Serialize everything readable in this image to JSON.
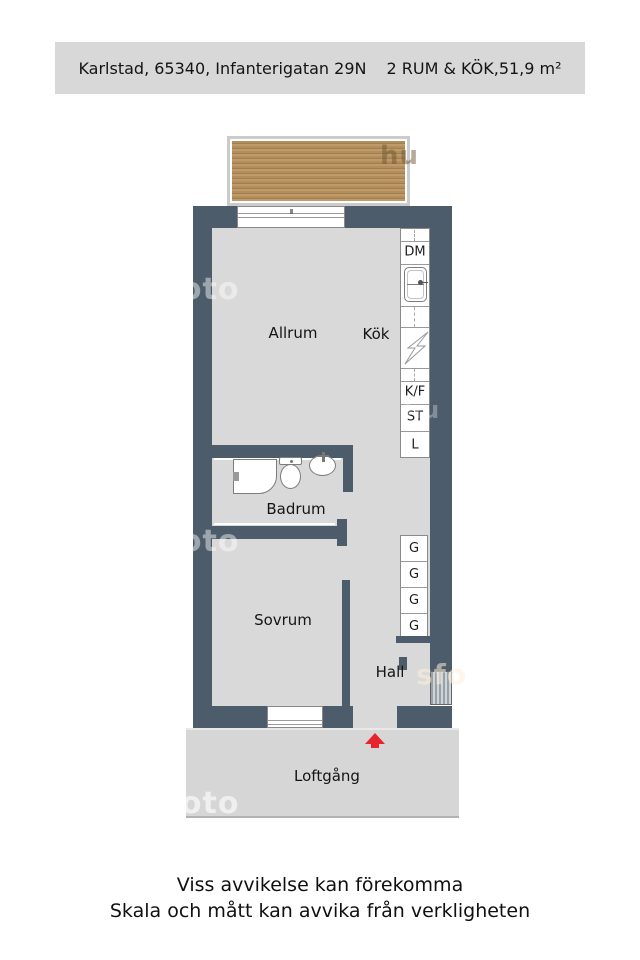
{
  "header": {
    "address": "Karlstad, 65340, Infanterigatan 29N",
    "details": "2 RUM & KÖK,51,9 m²"
  },
  "rooms": {
    "allrum": "Allrum",
    "kok": "Kök",
    "badrum": "Badrum",
    "sovrum": "Sovrum",
    "hall": "Hall",
    "loftgang": "Loftgång"
  },
  "kitchen_labels": {
    "dishwasher": "DM",
    "fridge_freezer": "K/F",
    "st": "ST",
    "l": "L"
  },
  "wardrobes": [
    "G",
    "G",
    "G",
    "G"
  ],
  "window_marker": "III",
  "watermarks": {
    "w1": "sfoto",
    "w2": "sfoto",
    "w3": "sfoto",
    "hu": "hu",
    "fo": "sfo",
    "hu2": "hu"
  },
  "footer": {
    "line1": "Viss avvikelse kan förekomma",
    "line2": "Skala och mått kan avvika från verkligheten"
  },
  "colors": {
    "wall": "#4d5c6b",
    "floor": "#d9d9d9",
    "loftgang": "#d6d6d6",
    "header_bg": "#d8d8d8",
    "red": "#e8232b",
    "wood_base": "#b18e5c",
    "wood_dark": "#9f7f4b",
    "wood_light": "#c09a6a",
    "frame": "#cbcbcb"
  }
}
